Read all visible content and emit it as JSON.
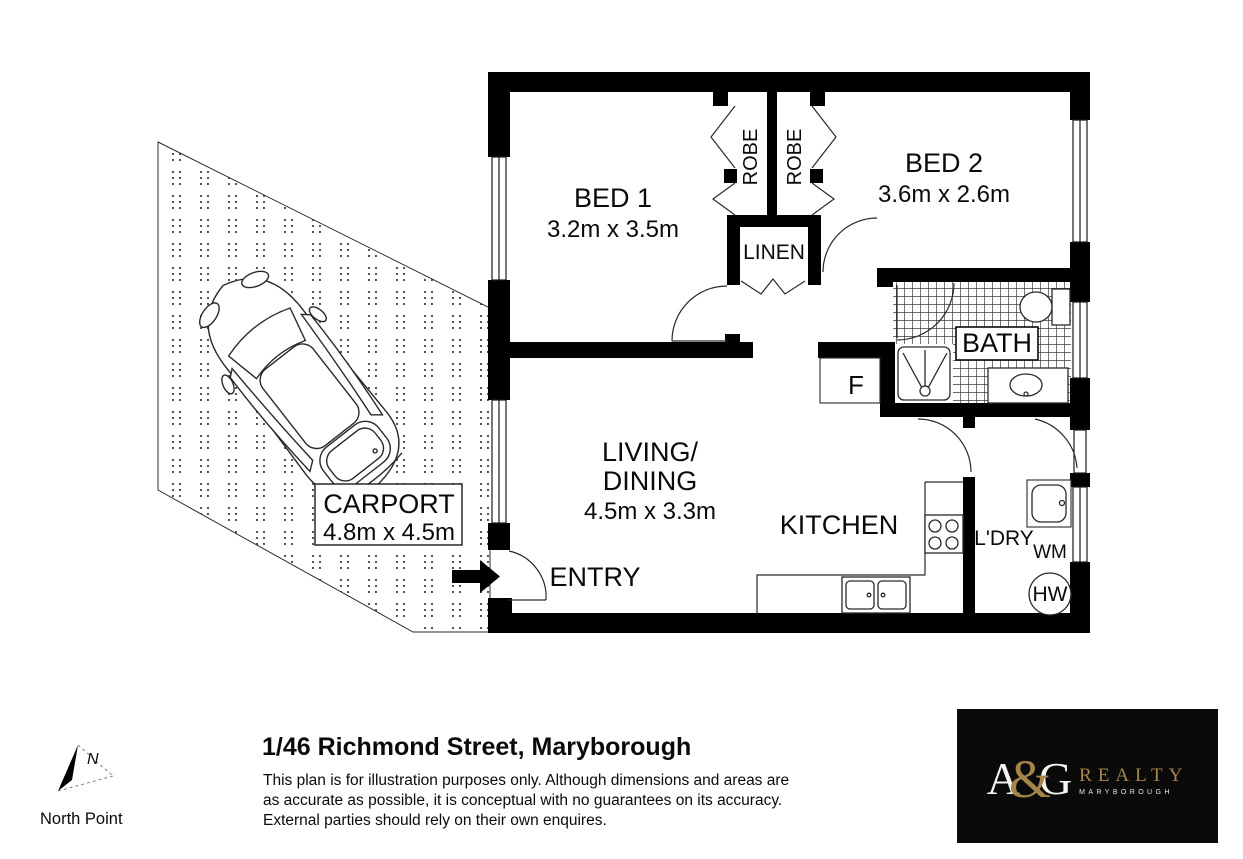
{
  "plan": {
    "rooms": {
      "bed1": {
        "name": "BED 1",
        "dims": "3.2m x 3.5m"
      },
      "bed2": {
        "name": "BED 2",
        "dims": "3.6m x 2.6m"
      },
      "living": {
        "line1": "LIVING/",
        "line2": "DINING",
        "dims": "4.5m x 3.3m"
      },
      "kitchen": {
        "name": "KITCHEN"
      },
      "carport": {
        "name": "CARPORT",
        "dims": "4.8m x 4.5m"
      },
      "entry": {
        "name": "ENTRY"
      },
      "linen": {
        "name": "LINEN"
      },
      "bath": {
        "name": "BATH"
      },
      "laundry": {
        "name": "L'DRY"
      },
      "robe1": {
        "name": "ROBE"
      },
      "robe2": {
        "name": "ROBE"
      }
    },
    "fixtures": {
      "fridge": "F",
      "washing_machine": "WM",
      "hot_water": "HW"
    }
  },
  "north_point": {
    "label": "North Point",
    "letter": "N"
  },
  "footer": {
    "title": "1/46 Richmond Street, Maryborough",
    "disclaimer_lines": [
      "This plan is for illustration purposes only.  Although dimensions and areas are",
      "as accurate as possible, it is conceptual with no guarantees on its accuracy.",
      "External parties should rely on their own enquires."
    ]
  },
  "logo": {
    "a": "A",
    "amp": "&",
    "g": "G",
    "realty": "REALTY",
    "location": "MARYBOROUGH",
    "gold_color": "#a6854a",
    "background_color": "#0a0a0a"
  }
}
